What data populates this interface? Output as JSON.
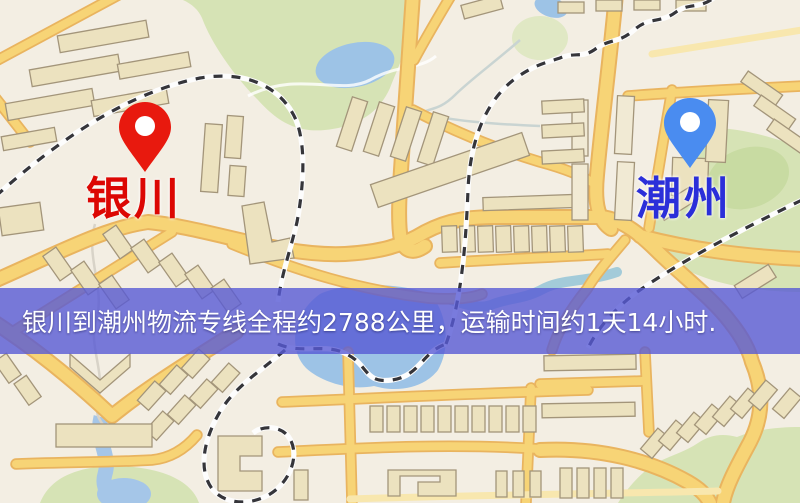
{
  "map": {
    "origin": {
      "label": "银川"
    },
    "destination": {
      "label": "潮州"
    },
    "banner": {
      "text": "银川到潮州物流专线全程约2788公里，运输时间约1天14小时."
    }
  },
  "icons": {
    "origin_pin": "red-location-pin",
    "destination_pin": "blue-location-pin"
  },
  "colors": {
    "origin_pin": "#e8190e",
    "origin_label": "#dc0703",
    "destination_pin": "#4a8cf0",
    "destination_label": "#2b2fd9",
    "banner_background": "#5a5cd4",
    "banner_text": "#ffffff",
    "road": "#f7d476",
    "park": "#d6e3b5",
    "water": "#9dc3e6"
  }
}
